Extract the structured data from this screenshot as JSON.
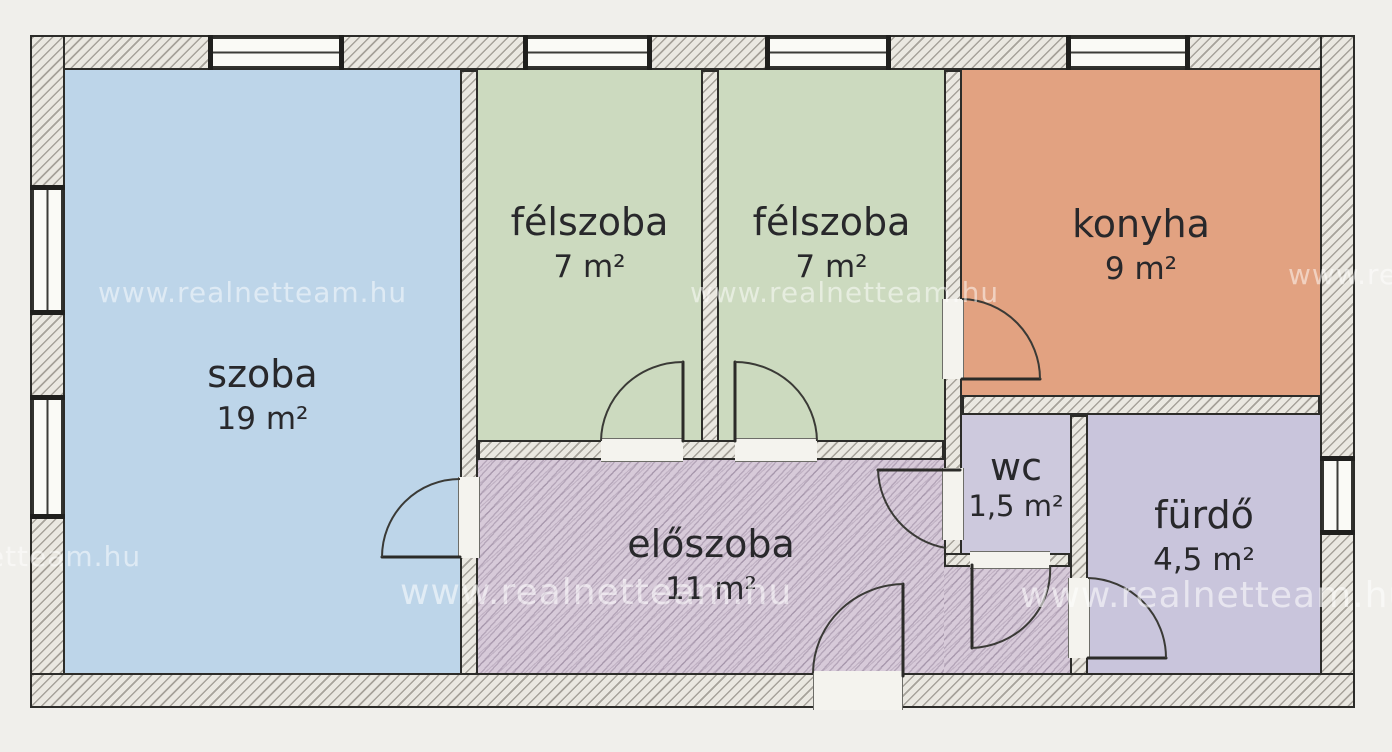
{
  "plan": {
    "watermark": "www.realnetteam.hu",
    "outline_color": "#2c2c29",
    "rooms": [
      {
        "id": "szoba",
        "label": "szoba",
        "area": "19 m²",
        "color": "#bdd5e9"
      },
      {
        "id": "felszoba-1",
        "label": "félszoba",
        "area": "7 m²",
        "color": "#ccdabf"
      },
      {
        "id": "felszoba-2",
        "label": "félszoba",
        "area": "7 m²",
        "color": "#ccdabf"
      },
      {
        "id": "konyha",
        "label": "konyha",
        "area": "9 m²",
        "color": "#e2a281"
      },
      {
        "id": "eloszoba",
        "label": "előszoba",
        "area": "11 m²",
        "color": "#d7cad9"
      },
      {
        "id": "wc",
        "label": "wc",
        "area": "1,5 m²",
        "color": "#cdc9dd"
      },
      {
        "id": "furdo",
        "label": "fürdő",
        "area": "4,5 m²",
        "color": "#c9c5dc"
      }
    ]
  }
}
